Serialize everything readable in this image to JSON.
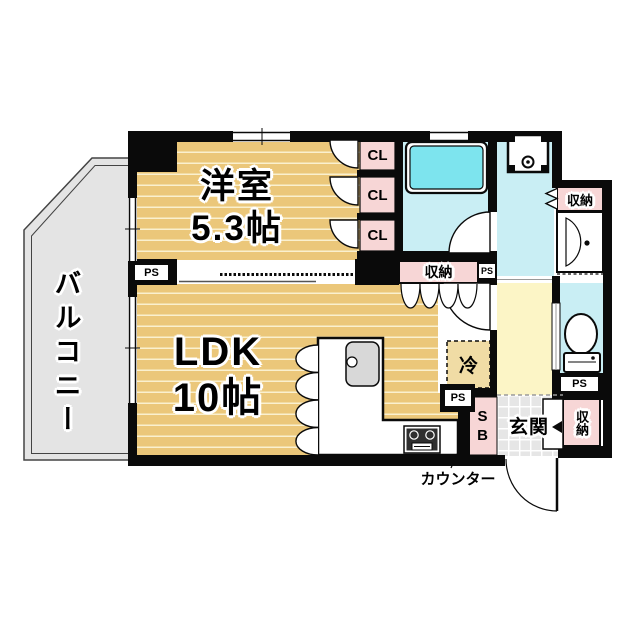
{
  "floorplan": {
    "balcony_label": "バルコニー",
    "western_room": {
      "name": "洋室",
      "size": "5.3帖"
    },
    "ldk": {
      "name": "LDK",
      "size": "10帖"
    },
    "closet1": "CL",
    "closet2": "CL",
    "closet3": "CL",
    "storage_washroom": "収納",
    "storage_ldk": "収納",
    "storage_entrance": "収納",
    "fridge": "冷",
    "entrance": "玄関",
    "shoebox": "SB",
    "counter_label": "カウンター",
    "ps_left": "PS",
    "ps_mid": "PS",
    "ps_kitchen": "PS",
    "ps_toilet": "PS",
    "colors": {
      "floor_wood": "#ebc77a",
      "floor_stripe": "#faf0cf",
      "closet_pink": "#f7d6d6",
      "bathtub_cyan": "#7de4ee",
      "wet_floor_cyan": "#c9eef4",
      "hallway_yellow": "#fcf5c6",
      "balcony_gray": "#e4e4e4",
      "entrance_tile_gray": "#e6e6e6",
      "wall_black": "#0a0a0a"
    }
  }
}
